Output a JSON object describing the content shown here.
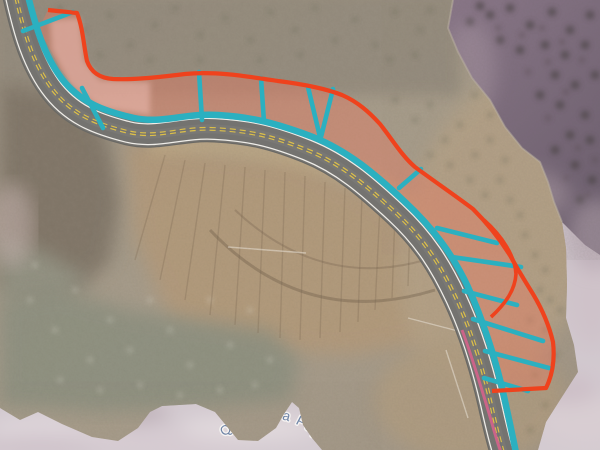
{
  "map": {
    "description": "aerial orthophoto with GIS slope-survey overlay along mountain highway",
    "feature_label": {
      "text": "Quebrada Papu",
      "color": "#6e84a6",
      "halo_color": "#f6f3f2"
    },
    "road": {
      "surface_color": "#747370",
      "edge_line_color": "#efede8",
      "center_line_color": "#dcbf4a"
    },
    "overlays": {
      "survey_line_color": "#2bb0c0",
      "zone_outline_color": "#ef421d",
      "zone_fill_color": "rgba(242,118,92,0.38)",
      "zone_fill_light_color": "rgba(252,205,198,0.42)",
      "aux_line_color": "#cb6488",
      "section_line_count": 13
    },
    "basemap": {
      "cloud_color": "#cbc1c7",
      "hill_shade_color": "#816f80"
    }
  }
}
